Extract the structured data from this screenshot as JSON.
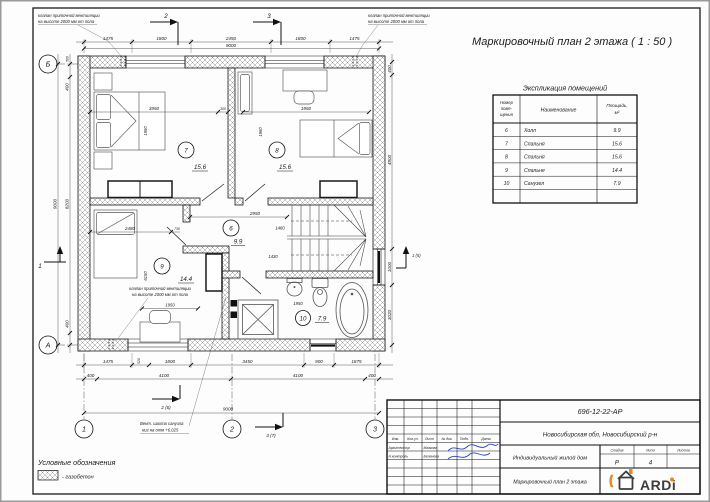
{
  "sheet": {
    "title": "Маркировочный план 2 этажа ( 1 : 50 )"
  },
  "explication": {
    "title": "Экспликация помещений",
    "col_number_lines": [
      "Номер",
      "поме-",
      "щения"
    ],
    "col_name": "Наименование",
    "col_area_lines": [
      "Площадь,",
      "м²"
    ],
    "rows": [
      {
        "number": "6",
        "name": "Холл",
        "area": "9.9"
      },
      {
        "number": "7",
        "name": "Спальня",
        "area": "15.6"
      },
      {
        "number": "8",
        "name": "Спальня",
        "area": "15.6"
      },
      {
        "number": "9",
        "name": "Спальня",
        "area": "14.4"
      },
      {
        "number": "10",
        "name": "Санузел",
        "area": "7.9"
      }
    ]
  },
  "legend": {
    "title": "Условные обозначения",
    "item": "- газобетон"
  },
  "titleblock": {
    "doc_number": "696-12-22-АР",
    "location": "Новосибирская обл, Новосибирский р-н",
    "object": "Индивидуальный жилой дом",
    "sheet_name": "Маркировочный план 2 этажа",
    "cols": [
      "Изм.",
      "Кол.уч.",
      "Лист",
      "№ док.",
      "Подп.",
      "Дата"
    ],
    "roles": [
      {
        "role": "Архитектор",
        "name": "Мазкова"
      },
      {
        "role": "Н.контроль",
        "name": "Беленева"
      }
    ],
    "stage_label": "Стадия",
    "list_label": "Лист",
    "lists_label": "Листов",
    "stage": "Р",
    "list_no": "4",
    "logo_text": "ARDi",
    "logo_accent": "#e8881f"
  },
  "plan": {
    "room7": {
      "num": "7",
      "area": "15.6"
    },
    "room8": {
      "num": "8",
      "area": "15.6"
    },
    "room9": {
      "num": "9",
      "area": "14.4"
    },
    "hall": {
      "num": "6",
      "area": "9.9"
    },
    "bath": {
      "num": "10",
      "area": "7.9"
    },
    "axes": {
      "a": "А",
      "b": "Б",
      "x1": "1",
      "x2": "2",
      "x3": "3"
    },
    "sections": {
      "top2": "2",
      "top3": "3",
      "left1": "1",
      "right1": "1 (5)",
      "bottom2": "2 (6)",
      "bottom3": "3 (7)"
    },
    "notes": {
      "vent_valve_l1": "клапан приточной вентиляции",
      "vent_valve_l2": "на высоте 2000 мм от пола",
      "vent_shaft_l1": "Вент. шахта санузла",
      "vent_shaft_l2": "низ на отм +6.025"
    },
    "dims": {
      "top": [
        "1475",
        "1800",
        "2450",
        "1800",
        "1475"
      ],
      "top_total": "9000",
      "bottom_a": [
        "1475",
        "520",
        "1800",
        "3450",
        "900",
        "1875"
      ],
      "bottom_b": [
        "400",
        "4100",
        "4100",
        "400"
      ],
      "bottom_total": "9000",
      "left": [
        "500",
        "400",
        "8200",
        "400"
      ],
      "left_total": "9000",
      "right": [
        "400",
        "4900",
        "1000",
        "3020"
      ],
      "room7": [
        "3950",
        "300",
        "1960"
      ],
      "room8": [
        "1950",
        "1960"
      ],
      "room9": [
        "2480",
        "730",
        "6150",
        "1950"
      ],
      "hall": [
        "2950",
        "1480",
        "1430"
      ],
      "bath": [
        "1950"
      ]
    }
  }
}
